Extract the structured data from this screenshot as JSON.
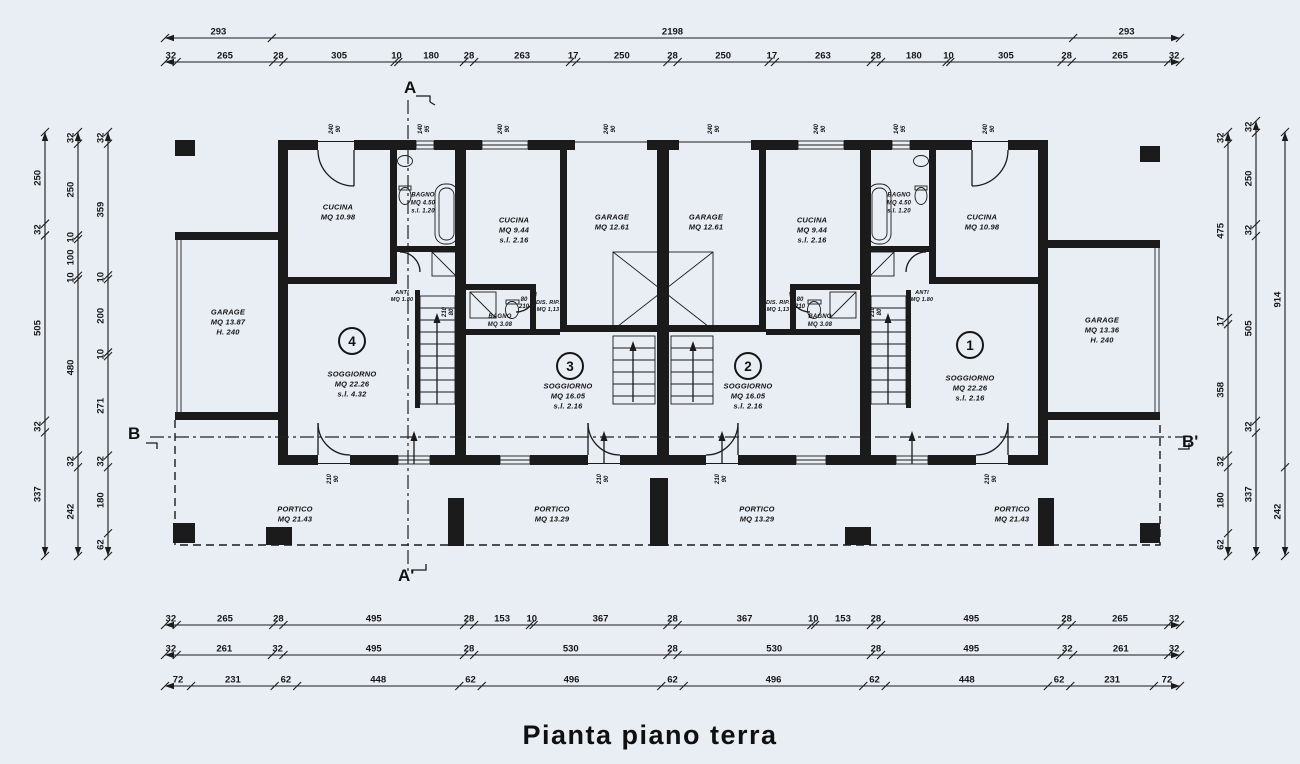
{
  "title": "Pianta piano terra",
  "colors": {
    "paper": "#e9edf4",
    "ink": "#1b1b1b"
  },
  "section_markers": [
    {
      "id": "a-top",
      "label": "A"
    },
    {
      "id": "a-bottom",
      "label": "A'"
    },
    {
      "id": "b-left",
      "label": "B"
    },
    {
      "id": "b-right",
      "label": "B'"
    }
  ],
  "unit_numbers": [
    {
      "id": "unit-4",
      "label": "4"
    },
    {
      "id": "unit-3",
      "label": "3"
    },
    {
      "id": "unit-2",
      "label": "2"
    },
    {
      "id": "unit-1",
      "label": "1"
    }
  ],
  "rooms": [
    {
      "id": "garage-left",
      "lines": [
        "GARAGE",
        "MQ 13.87",
        "H. 240"
      ]
    },
    {
      "id": "cucina-4",
      "lines": [
        "CUCINA",
        "MQ 10.98"
      ]
    },
    {
      "id": "bagno-4",
      "lines": [
        "BAGNO",
        "MQ 4.50",
        "s.l. 1.20"
      ]
    },
    {
      "id": "anti-4",
      "lines": [
        "ANTI",
        "MQ 1.80"
      ]
    },
    {
      "id": "soggiorno-4",
      "lines": [
        "SOGGIORNO",
        "MQ 22.26",
        "s.l. 4.32"
      ]
    },
    {
      "id": "cucina-3",
      "lines": [
        "CUCINA",
        "MQ 9.44",
        "s.l. 2.16"
      ]
    },
    {
      "id": "garage-3",
      "lines": [
        "GARAGE",
        "MQ 12.61"
      ]
    },
    {
      "id": "bagno-3",
      "lines": [
        "BAGNO",
        "MQ 3.08"
      ]
    },
    {
      "id": "disrip-3",
      "lines": [
        "DIS. RIP.",
        "MQ 1,13"
      ]
    },
    {
      "id": "soggiorno-3",
      "lines": [
        "SOGGIORNO",
        "MQ 16.05",
        "s.l. 2.16"
      ]
    },
    {
      "id": "garage-2",
      "lines": [
        "GARAGE",
        "MQ 12.61"
      ]
    },
    {
      "id": "cucina-2",
      "lines": [
        "CUCINA",
        "MQ 9.44",
        "s.l. 2.16"
      ]
    },
    {
      "id": "bagno-2",
      "lines": [
        "BAGNO",
        "MQ 3.08"
      ]
    },
    {
      "id": "disrip-2",
      "lines": [
        "DIS. RIP.",
        "MQ 1,13"
      ]
    },
    {
      "id": "soggiorno-2",
      "lines": [
        "SOGGIORNO",
        "MQ 16.05",
        "s.l. 2.16"
      ]
    },
    {
      "id": "cucina-1",
      "lines": [
        "CUCINA",
        "MQ 10.98"
      ]
    },
    {
      "id": "bagno-1",
      "lines": [
        "BAGNO",
        "MQ 4.50",
        "s.l. 1.20"
      ]
    },
    {
      "id": "anti-1",
      "lines": [
        "ANTI",
        "MQ 1.80"
      ]
    },
    {
      "id": "soggiorno-1",
      "lines": [
        "SOGGIORNO",
        "MQ 22.26",
        "s.l. 2.16"
      ]
    },
    {
      "id": "garage-right",
      "lines": [
        "GARAGE",
        "MQ 13.36",
        "H. 240"
      ]
    },
    {
      "id": "portico-4",
      "lines": [
        "PORTICO",
        "MQ 21.43"
      ]
    },
    {
      "id": "portico-3",
      "lines": [
        "PORTICO",
        "MQ 13.29"
      ]
    },
    {
      "id": "portico-2",
      "lines": [
        "PORTICO",
        "MQ 13.29"
      ]
    },
    {
      "id": "portico-1",
      "lines": [
        "PORTICO",
        "MQ 21.43"
      ]
    }
  ],
  "annotations": [
    {
      "id": "w1",
      "lines": [
        "240",
        "90"
      ]
    },
    {
      "id": "w2",
      "lines": [
        "140",
        "95"
      ]
    },
    {
      "id": "w3",
      "lines": [
        "240",
        "90"
      ]
    },
    {
      "id": "g1",
      "lines": [
        "240",
        "90"
      ]
    },
    {
      "id": "g2",
      "lines": [
        "240",
        "90"
      ]
    },
    {
      "id": "w4",
      "lines": [
        "240",
        "90"
      ]
    },
    {
      "id": "w5",
      "lines": [
        "140",
        "95"
      ]
    },
    {
      "id": "w6",
      "lines": [
        "240",
        "90"
      ]
    },
    {
      "id": "d1",
      "lines": [
        "210",
        "90"
      ]
    },
    {
      "id": "d2",
      "lines": [
        "210",
        "90"
      ]
    },
    {
      "id": "d3",
      "lines": [
        "210",
        "90"
      ]
    },
    {
      "id": "d4",
      "lines": [
        "210",
        "90"
      ]
    },
    {
      "id": "i1",
      "lines": [
        "80",
        "210"
      ]
    },
    {
      "id": "i2",
      "lines": [
        "80",
        "210"
      ]
    },
    {
      "id": "i3",
      "lines": [
        "210",
        "80"
      ]
    },
    {
      "id": "i4",
      "lines": [
        "210",
        "80"
      ]
    }
  ],
  "dimensions": {
    "top_row1": [
      "293",
      "2198",
      "293"
    ],
    "top_row2": [
      "32",
      "265",
      "28",
      "305",
      "10",
      "180",
      "28",
      "263",
      "17",
      "250",
      "28",
      "250",
      "17",
      "263",
      "28",
      "180",
      "10",
      "305",
      "28",
      "265",
      "32"
    ],
    "bottom_row1": [
      "32",
      "265",
      "28",
      "495",
      "28",
      "153",
      "10",
      "367",
      "28",
      "367",
      "10",
      "153",
      "28",
      "495",
      "28",
      "265",
      "32"
    ],
    "bottom_row2": [
      "32",
      "261",
      "32",
      "495",
      "28",
      "530",
      "28",
      "530",
      "28",
      "495",
      "32",
      "261",
      "32"
    ],
    "bottom_row3": [
      "72",
      "231",
      "62",
      "448",
      "62",
      "496",
      "62",
      "496",
      "62",
      "448",
      "62",
      "231",
      "72"
    ],
    "left_col_outer": [
      "250",
      "32",
      "505",
      "32",
      "337"
    ],
    "left_col_mid": [
      "32",
      "250",
      "10",
      "100",
      "10",
      "480",
      "32",
      "242"
    ],
    "left_col_inner": [
      "32",
      "359",
      "10",
      "200",
      "10",
      "271",
      "32",
      "180",
      "62"
    ],
    "right_col_inner": [
      "32",
      "475",
      "17",
      "358",
      "32",
      "180",
      "62"
    ],
    "right_col_mid": [
      "32",
      "250",
      "32",
      "505",
      "32",
      "337"
    ],
    "right_col_outer": [
      "914",
      "242"
    ]
  }
}
